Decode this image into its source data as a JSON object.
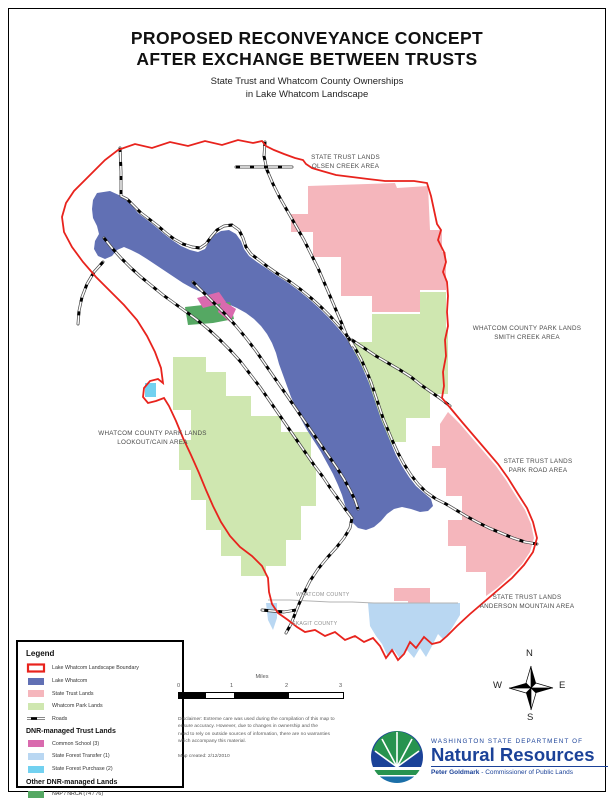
{
  "title": {
    "line1": "PROPOSED RECONVEYANCE CONCEPT",
    "line2": "AFTER EXCHANGE BETWEEN TRUSTS",
    "subtitle1": "State Trust and Whatcom County Ownerships",
    "subtitle2": "in Lake Whatcom Landscape"
  },
  "map_labels": {
    "olsen": {
      "line1": "STATE TRUST LANDS",
      "line2": "OLSEN CREEK AREA"
    },
    "smith": {
      "line1": "WHATCOM COUNTY PARK LANDS",
      "line2": "SMITH CREEK AREA"
    },
    "park_road": {
      "line1": "STATE TRUST LANDS",
      "line2": "PARK ROAD AREA"
    },
    "anderson": {
      "line1": "STATE TRUST LANDS",
      "line2": "ANDERSON MOUNTAIN AREA"
    },
    "lookout": {
      "line1": "WHATCOM COUNTY PARK LANDS",
      "line2": "LOOKOUT/CAIN AREA"
    },
    "whatcom_county": "WHATCOM COUNTY",
    "skagit_county": "SKAGIT COUNTY"
  },
  "legend": {
    "title": "Legend",
    "item_boundary": "Lake Whatcom Landscape Boundary",
    "item_lake": "Lake Whatcom",
    "item_trust": "State Trust Lands",
    "item_park": "Whatcom Park Lands",
    "item_roads": "Roads",
    "header_trust": "DNR-managed Trust Lands",
    "item_common_school": "Common School (3)",
    "item_forest_transfer": "State Forest Transfer (1)",
    "item_forest_purchase": "State Forest Purchase (2)",
    "header_other": "Other DNR-managed Lands",
    "item_nap": "NAP / NRCA (74 / 76)"
  },
  "scalebar": {
    "unit": "Miles",
    "tick0": "0",
    "tick1": "1",
    "tick2": "2",
    "tick3": "3"
  },
  "compass": {
    "n": "N",
    "e": "E",
    "s": "S",
    "w": "W"
  },
  "notes": {
    "disclaimer1": "Disclaimer: Extreme care was used during the compilation of this map to",
    "disclaimer2": "ensure accuracy. However, due to changes in ownership and the",
    "disclaimer3": "need to rely on outside sources of information, there are no warranties",
    "disclaimer4": "which accompany this material.",
    "map_created": "Map created: 2/12/2010"
  },
  "logo": {
    "department": "WASHINGTON STATE DEPARTMENT OF",
    "agency": "Natural Resources",
    "commissioner_name": "Peter Goldmark",
    "commissioner_title": " - Commissioner of Public Lands"
  },
  "colors": {
    "boundary": "#e8231d",
    "lake": "#6170b4",
    "state_trust": "#f5b6bc",
    "park_lands": "#cfe7b0",
    "common_school": "#d96aae",
    "forest_transfer": "#b9d7f2",
    "forest_purchase": "#72d1f0",
    "nap_nrca": "#55a863",
    "county_line": "#b3b3b3",
    "logo_blue": "#1b4298",
    "logo_green": "#27934f",
    "logo_teal": "#1b6fa8"
  }
}
